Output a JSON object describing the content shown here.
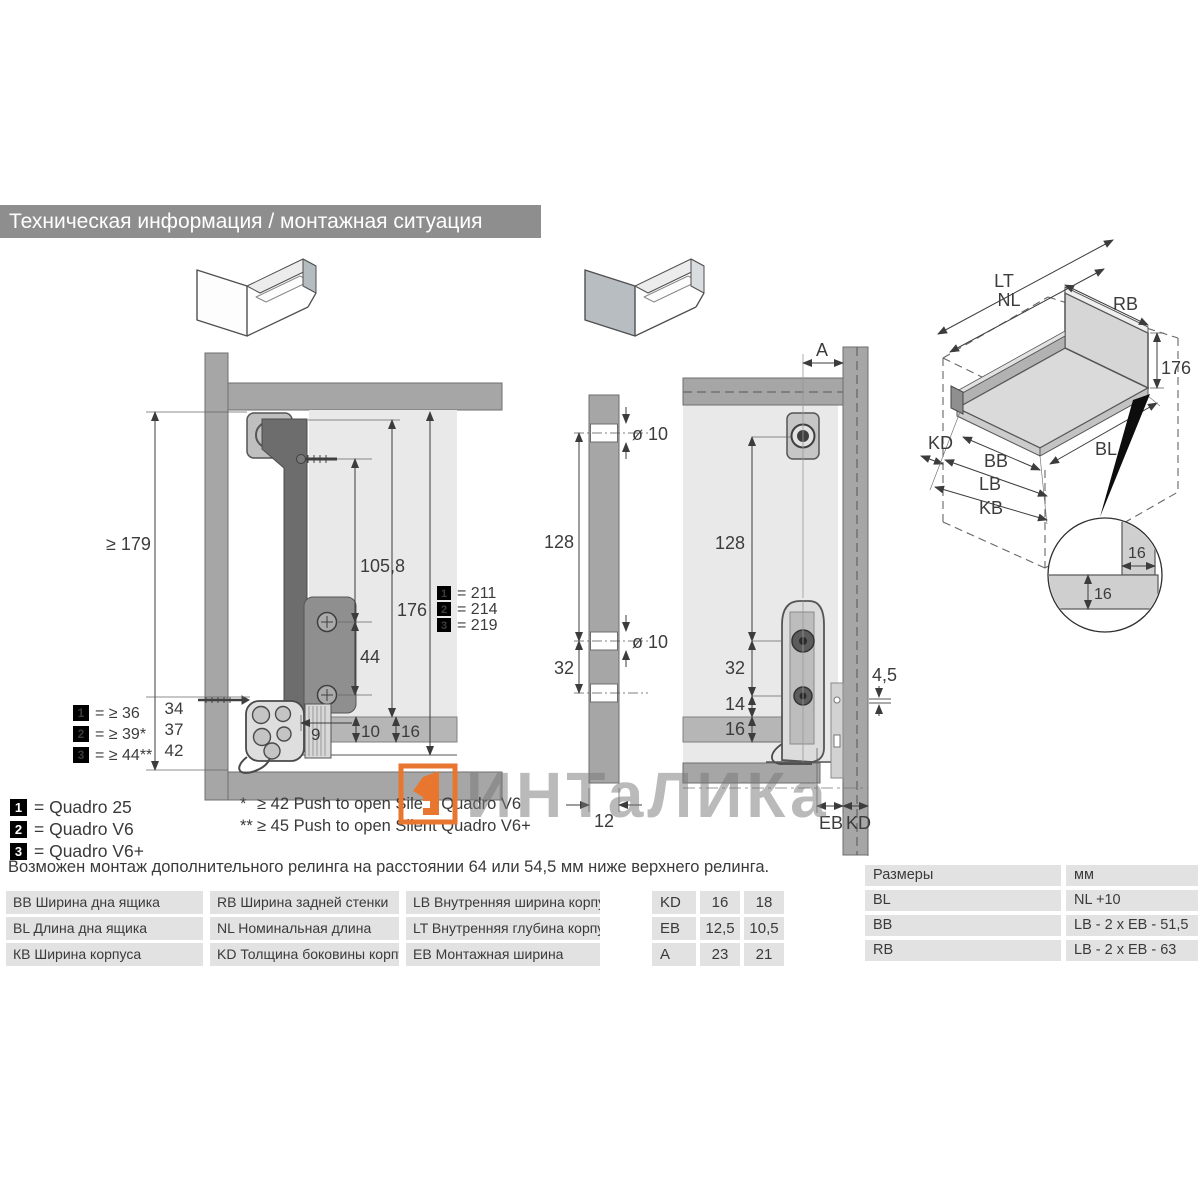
{
  "page": {
    "title": "Техническая информация / монтажная ситуация"
  },
  "watermark": {
    "text": "ИНТаЛИКа",
    "accent_color": "#e8762f"
  },
  "side": {
    "d179": "≥ 179",
    "d1058": "105,8",
    "d176": "176",
    "d44": "44",
    "d9": "9",
    "d10": "10",
    "d16": "16",
    "stack": [
      "34",
      "37",
      "42"
    ],
    "min_legend": [
      {
        "n": "1",
        "v": "= ≥ 36"
      },
      {
        "n": "2",
        "v": "= ≥ 39*"
      },
      {
        "n": "3",
        "v": "= ≥ 44**"
      }
    ],
    "height_legend": [
      {
        "n": "1",
        "v": "= 211"
      },
      {
        "n": "2",
        "v": "= 214"
      },
      {
        "n": "3",
        "v": "= 219"
      }
    ]
  },
  "strip": {
    "dia": "ø 10",
    "d128": "128",
    "d32": "32",
    "d12": "12"
  },
  "back": {
    "dA": "A",
    "d128": "128",
    "d32": "32",
    "d14": "14",
    "d16": "16",
    "d45": "4,5",
    "eb": "EB",
    "kd": "KD"
  },
  "iso": {
    "lt": "LT",
    "nl": "NL",
    "rb": "RB",
    "d176": "176",
    "kd": "KD",
    "bb": "BB",
    "lb": "LB",
    "kb": "KB",
    "bl": "BL"
  },
  "detail": {
    "d16": "16"
  },
  "products": [
    {
      "n": "1",
      "v": "= Quadro 25"
    },
    {
      "n": "2",
      "v": "= Quadro V6"
    },
    {
      "n": "3",
      "v": "= Quadro V6+"
    }
  ],
  "footnotes": [
    {
      "m": "*",
      "t": "≥ 42 Push to open Silent Quadro V6"
    },
    {
      "m": "**",
      "t": "≥ 45 Push to open Silent Quadro V6+"
    }
  ],
  "note": "Возможен монтаж дополнительного релинга на расстоянии 64 или 54,5 мм ниже верхнего релинга.",
  "glossary": [
    [
      "BB Ширина дна ящика",
      "RB Ширина задней стенки",
      "LB Внутренняя ширина корпуса"
    ],
    [
      "BL Длина дна ящика",
      "NL Номинальная длина",
      "LT Внутренняя глубина корпуса"
    ],
    [
      "КВ Ширина корпуса",
      "KD Толщина боковины корпуса",
      "EB Монтажная ширина"
    ]
  ],
  "kd_table": [
    [
      "KD",
      "16",
      "18"
    ],
    [
      "EB",
      "12,5",
      "10,5"
    ],
    [
      "A",
      "23",
      "21"
    ]
  ],
  "size_table": {
    "header": [
      "Размеры",
      "мм"
    ],
    "rows": [
      [
        "BL",
        "NL +10"
      ],
      [
        "BB",
        "LB - 2 x EB - 51,5"
      ],
      [
        "RB",
        "LB - 2 x EB - 63"
      ]
    ]
  }
}
